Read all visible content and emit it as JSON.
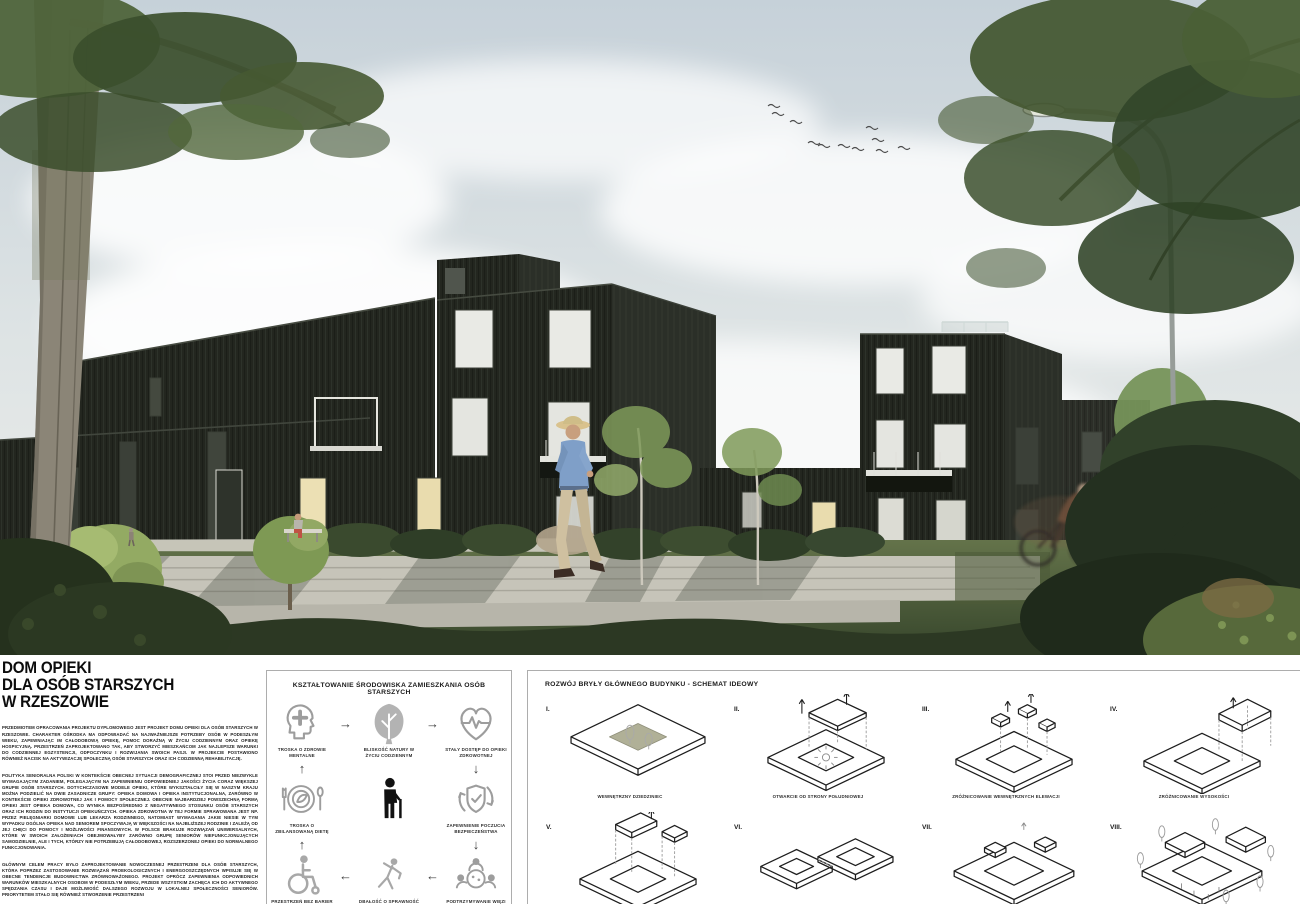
{
  "poster": {
    "heading_lines": [
      "DOM OPIEKI",
      "DLA OSÓB STARSZYCH",
      "W RZESZOWIE"
    ],
    "paragraphs": [
      "PRZEDMIOTEM OPRACOWANIA PROJEKTU DYPLOMOWEGO JEST PROJEKT DOMU OPIEKI DLA OSÓB STARSZYCH W RZESZOWIE. CHARAKTER OŚRODKA MA ODPOWIADAĆ NA NAJWAŻNIEJSZE POTRZEBY OSÓB W PODESZŁYM WIEKU, ZAPEWNIAJĄC IM CAŁODOBOWĄ OPIEKĘ, POMOC DORAŹNĄ W ŻYCIU CODZIENNYM ORAZ OPIEKĘ HOSPICYJNĄ. PRZESTRZEŃ ZAPROJEKTOWANO TAK, ABY STWORZYĆ MIESZKAŃCOM JAK NAJLEPSZE WARUNKI DO CODZIENNEJ EGZYSTENCJI, ODPOCZYNKU I ROZWIJANIA SWOICH PASJI. W PROJEKCIE POSTAWIONO RÓWNIEŻ NACISK NA AKTYWIZACJĘ SPOŁECZNĄ OSÓB STARSZYCH ORAZ ICH CODZIENNĄ REHABILITACJĘ.",
      "POLITYKA SENIORALNA POLSKI W KONTEKŚCIE OBECNEJ SYTUACJI DEMOGRAFICZNEJ STOI PRZED NIEZWYKLE WYMAGAJĄCYM ZADANIEM, POLEGAJĄCYM NA ZAPEWNIENIU ODPOWIEDNIEJ JAKOŚCI ŻYCIA CORAZ WIĘKSZEJ GRUPIE OSÓB STARSZYCH. DOTYCHCZASOWE MODELE OPIEKI, KTÓRE WYKSZTAŁCIŁY SIĘ W NASZYM KRAJU MOŻNA PODZIELIĆ NA DWIE ZASADNICZE GRUPY: OPIEKA DOMOWA I OPIEKA INSTYTUCJONALNA, ZARÓWNO W KONTEKŚCIE OPIEKI ZDROWOTNEJ JAK I POMOCY SPOŁECZNEJ. OBECNIE NAJBARDZIEJ POWSZECHNĄ FORMĄ OPIEKI JEST OPIEKA DOMOWA, CO WYNIKA BEZPOŚREDNIO Z NEGATYWNEGO STOSUNKU OSÓB STARSZYCH ORAZ ICH RODZIN DO INSTYTUCJI OPIEKUŃCZYCH. OPIEKA ZDROWOTNA W TEJ FORMIE SPRAWOWANA JEST NP. PRZEZ PIELĘGNIARKI DOMOWE LUB LEKARZA RODZINNEGO, NATOMIAST WYMAGANIA JAKIE NIESIE W TYM WYPADKU OGÓLNA OPIEKA NAD SENIOREM SPOCZYWAJĄ W WIĘKSZOŚCI NA NAJBLIŻSZEJ RODZINIE I ZALEŻĄ OD JEJ CHĘCI DO POMOCY I MOŻLIWOŚCI FINANSOWYCH. W POLSCE BRAKUJE ROZWIĄZAŃ UNIWERSALNYCH, KTÓRE W SWOICH ZAŁOŻENIACH OBEJMOWAŁYBY ZARÓWNO GRUPĘ SENIORÓW NIEFUNKCJONUJĄCYCH SAMODZIELNIE, ALE I TYCH, KTÓRZY NIE POTRZEBUJĄ CAŁODOBOWEJ, ROZSZERZONEJ OPIEKI DO NORMALNEGO FUNKCJONOWANIA.",
      "GŁÓWNYM CELEM PRACY BYŁO ZAPROJEKTOWANIE NOWOCZESNEJ PRZESTRZENI DLA OSÓB STARSZYCH, KTÓRA POPRZEZ ZASTOSOWANIE ROZWIĄZAŃ PROEKOLOGICZNYCH I ENERGOOSZCZĘDNYCH WPISUJE SIĘ W OBECNE TENDENCJE BUDOWNICTWA ZRÓWNOWAŻONEGO. PROJEKT OPRÓCZ ZAPEWNIENIA ODPOWIEDNICH WARUNKÓW MIESZKALNYCH OSOBOM W PODESZŁYM WIEKU, PRZEDE WSZYSTKIM ZACHĘCA ICH DO AKTYWNEGO SPĘDZANIA CZASU I DAJE MOŻLIWOŚĆ DALSZEGO ROZWOJU W LOKALNEJ SPOŁECZNOŚCI SENIORÓW. PRIORYTETEM STAŁO SIĘ RÓWNIEŻ STWORZENIE PRZESTRZENI"
    ]
  },
  "env_panel": {
    "title": "KSZTAŁTOWANIE ŚRODOWISKA ZAMIESZKANIA OSÓB STARSZYCH",
    "items": [
      {
        "icon": "mental-health-head-cross-icon",
        "label": "TROSKA O ZDROWIE MENTALNE"
      },
      {
        "icon": "nature-tree-icon",
        "label": "BLISKOŚĆ NATURY W ŻYCIU CODZIENNYM"
      },
      {
        "icon": "heart-pulse-icon",
        "label": "STAŁY DOSTĘP DO OPIEKI ZDROWOTNEJ"
      },
      {
        "icon": "balanced-diet-plate-icon",
        "label": "TROSKA O ZBILANSOWANĄ DIETĘ"
      },
      {
        "icon": "elderly-person-cane-icon",
        "label": ""
      },
      {
        "icon": "shield-check-cycle-icon",
        "label": "ZAPEWNIENIE POCZUCIA BEZPIECZEŃSTWA"
      },
      {
        "icon": "wheelchair-icon",
        "label": "PRZESTRZEŃ BEZ BARIER"
      },
      {
        "icon": "exercise-stretch-icon",
        "label": "DBAŁOŚĆ O SPRAWNOŚĆ"
      },
      {
        "icon": "social-bonds-group-icon",
        "label": "PODTRZYMYWANIE WIĘZI"
      }
    ],
    "arrows": {
      "right": "→",
      "left": "←",
      "up": "↑",
      "down": "↓"
    }
  },
  "scheme_panel": {
    "title": "ROZWÓJ BRYŁY GŁÓWNEGO BUDYNKU - SCHEMAT IDEOWY",
    "steps": [
      {
        "numeral": "I.",
        "caption": "WEWNĘTRZNY DZIEDZINIEC"
      },
      {
        "numeral": "II.",
        "caption": "OTWARCIE OD STRONY POŁUDNIOWEJ"
      },
      {
        "numeral": "III.",
        "caption": "ZRÓŻNICOWANIE WEWNĘTRZNYCH ELEWACJI"
      },
      {
        "numeral": "IV.",
        "caption": "ZRÓŻNICOWANIE WYSOKOŚCI"
      },
      {
        "numeral": "V.",
        "caption": ""
      },
      {
        "numeral": "VI.",
        "caption": ""
      },
      {
        "numeral": "VII.",
        "caption": ""
      },
      {
        "numeral": "VIII.",
        "caption": ""
      }
    ]
  },
  "colors": {
    "facade_dark": "#23261f",
    "courtyard_olive": "#b0b097",
    "sky_top": "#c6d1d9",
    "grass_dark": "#3a4a2d",
    "icon_gray": "#9d9d9d"
  }
}
